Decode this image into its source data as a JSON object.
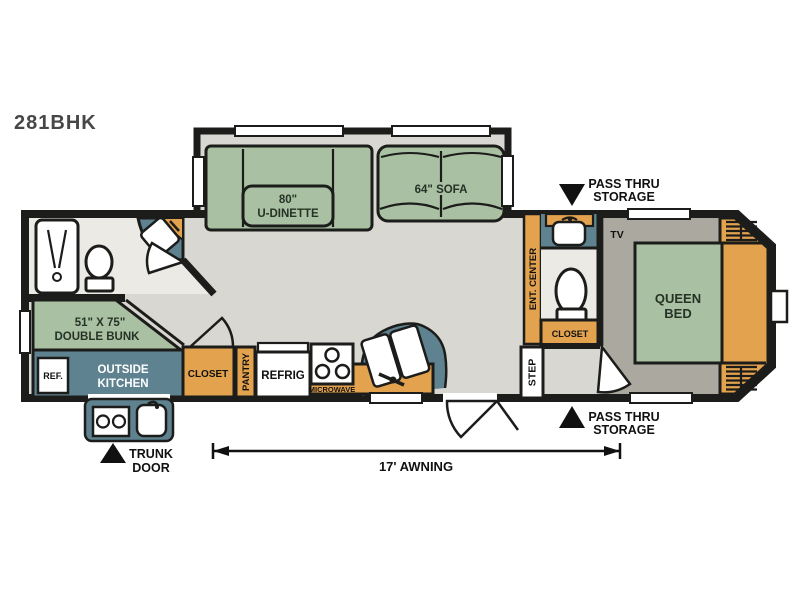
{
  "title": {
    "model": "281BHK"
  },
  "colors": {
    "wall": "#1c1c1a",
    "cabinet_orange": "#e2a24e",
    "counter_teal": "#5e8290",
    "furniture_green": "#a9c0a2",
    "floor_main": "#d8d7d2",
    "floor_bedroom": "#aba89f",
    "floor_bath": "#ebeae5"
  },
  "labels": {
    "dinette": {
      "line1": "80\"",
      "line2": "U-DINETTE"
    },
    "sofa": "64\" SOFA",
    "pass_thru_top": {
      "line1": "PASS THRU",
      "line2": "STORAGE"
    },
    "pass_thru_bottom": {
      "line1": "PASS THRU",
      "line2": "STORAGE"
    },
    "tv": "TV",
    "queen_bed": {
      "line1": "QUEEN",
      "line2": "BED"
    },
    "ent_center": "ENT. CENTER",
    "bath_closet": "CLOSET",
    "step": "STEP",
    "bunk": {
      "line1": "51\" X 75\"",
      "line2": "DOUBLE BUNK"
    },
    "outside_kitchen": {
      "line1": "OUTSIDE",
      "line2": "KITCHEN"
    },
    "ref": "REF.",
    "closet": "CLOSET",
    "pantry": "PANTRY",
    "refrig": "REFRIG",
    "microwave": "MICROWAVE",
    "trunk_door": {
      "line1": "TRUNK",
      "line2": "DOOR"
    },
    "awning": "17' AWNING"
  }
}
